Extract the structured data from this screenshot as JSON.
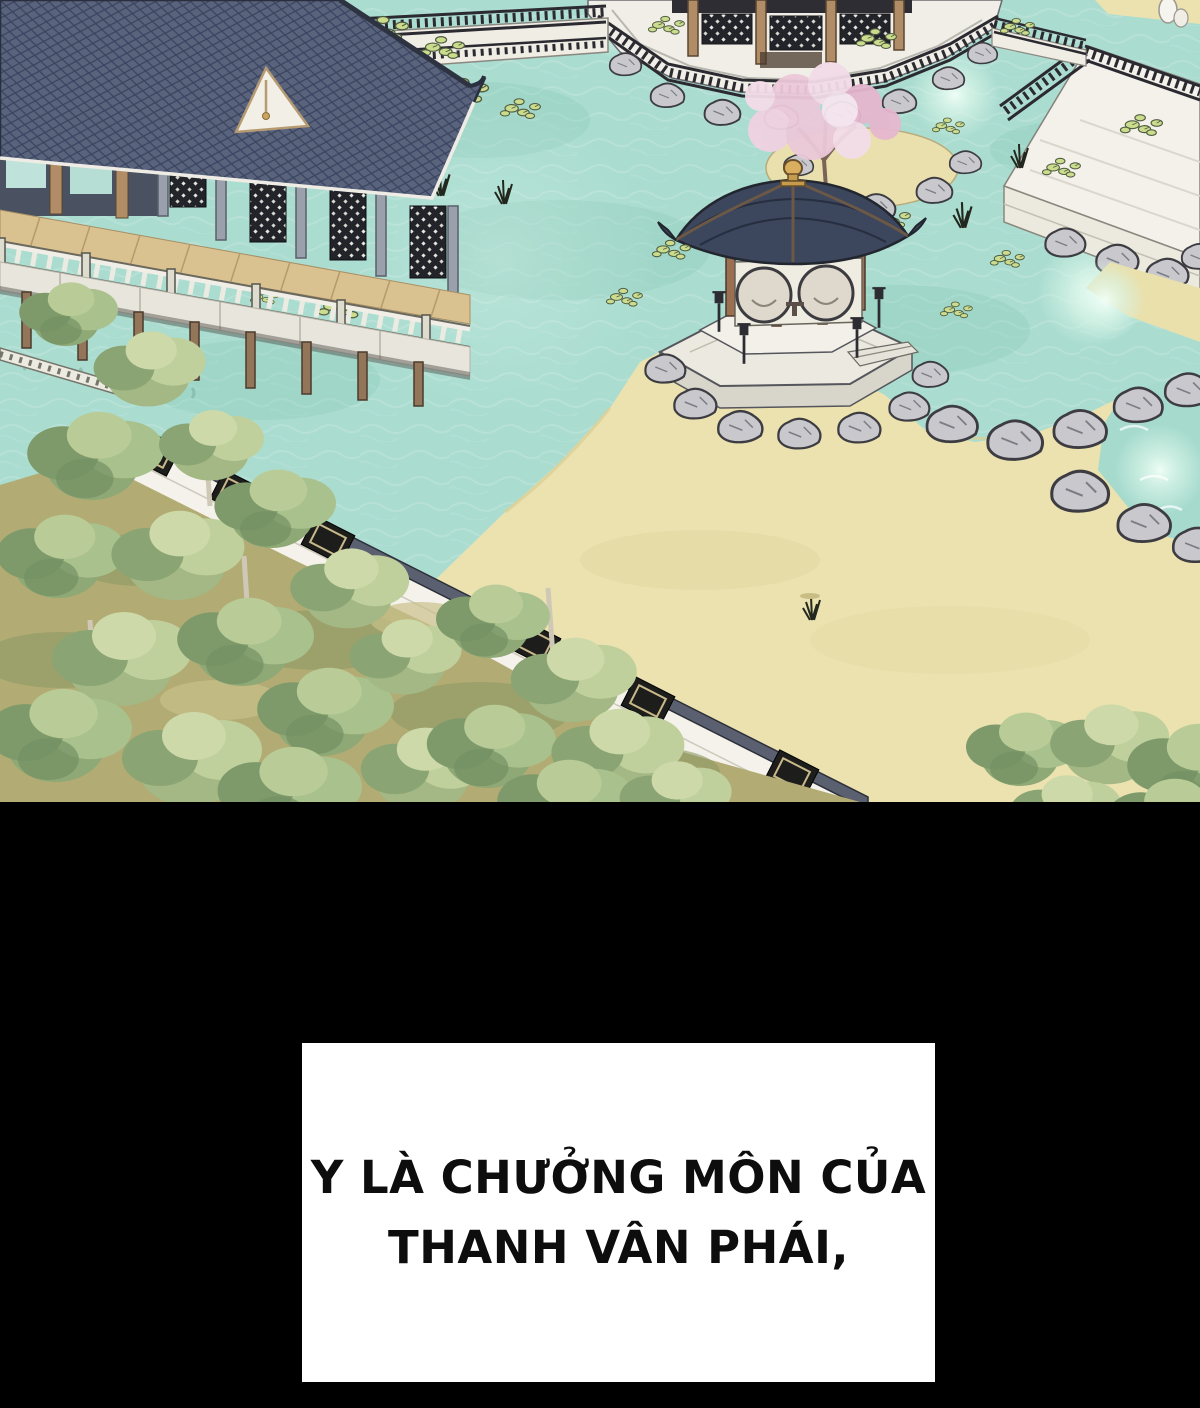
{
  "panel": {
    "type": "webtoon-comic-panel",
    "caption": {
      "lines": [
        "Y LÀ CHƯỞNG MÔN CỦA",
        "THANH VÂN PHÁI,"
      ]
    },
    "scene_alt": "Bird's-eye watercolor view of a sect garden: a grand pavilion hall on stilts over a turquoise lotus pond, an octagonal bridge pavilion, a hexagonal stone gazebo on a rocky island, a pink blossom tree, white garden walls with lattice windows, a sand courtyard, gray rocks and green trees; black letterbox below with a white caption box."
  },
  "colors": {
    "letterbox": "#000000",
    "caption_bg": "#ffffff",
    "caption_text": "#0d0d0d",
    "water": "#aadcd0",
    "water_light": "#cdeadd",
    "sand": "#ebe2af",
    "grass": "#b2ac74",
    "roof": "#4a5570",
    "roof_dark": "#39425c",
    "wood_deck": "#d9c190",
    "lattice_dark": "#23242a",
    "white_stone": "#f0eee6",
    "rock_gray": "#c9c9cd",
    "tree_green": "#8ea876",
    "lily_pad": "#ccdc8d",
    "blossom_pink": "#ecc9da",
    "column_wood": "#9a6f52",
    "finial_gold": "#d9ae5e"
  }
}
